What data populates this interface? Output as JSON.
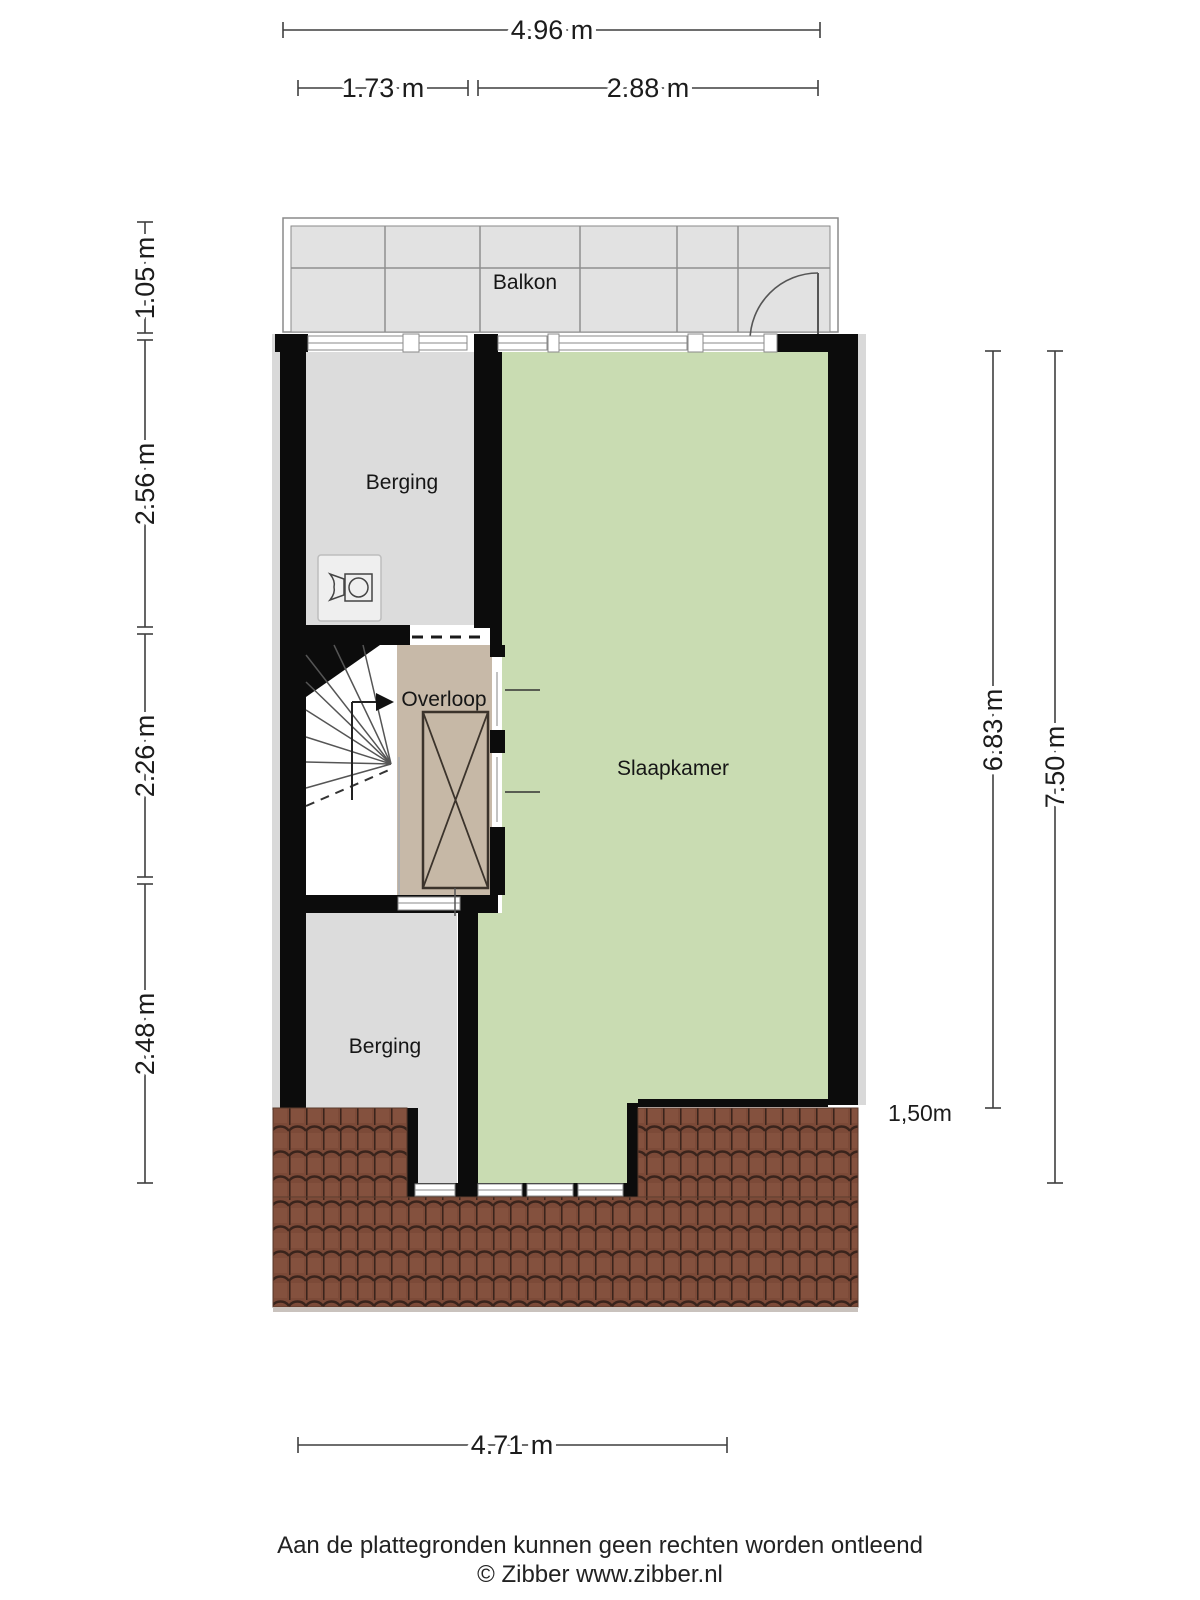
{
  "rooms": {
    "balkon": "Balkon",
    "berging_top": "Berging",
    "overloop": "Overloop",
    "slaapkamer": "Slaapkamer",
    "berging_bottom": "Berging"
  },
  "dimensions": {
    "top_total": "4.96 m",
    "top_left": "1.73 m",
    "top_right": "2.88 m",
    "left_balcony": "1.05 m",
    "left_berging": "2.56 m",
    "left_overloop": "2.26 m",
    "left_berging2": "2.48 m",
    "right_inner": "6.83 m",
    "right_outer": "7.50 m",
    "bottom": "4.71 m",
    "knee_wall": "1,50m"
  },
  "footer": {
    "disclaimer": "Aan de plattegronden kunnen geen rechten worden ontleend",
    "copyright": "© Zibber www.zibber.nl"
  },
  "colors": {
    "wall": "#0c0c0c",
    "berging": "#dcdcdc",
    "slaapkamer": "#c9dcb2",
    "overloop": "#c7b9a8",
    "balcony": "#e2e2e2",
    "roof_base": "#7c4a38",
    "roof_line": "#3a241c"
  }
}
